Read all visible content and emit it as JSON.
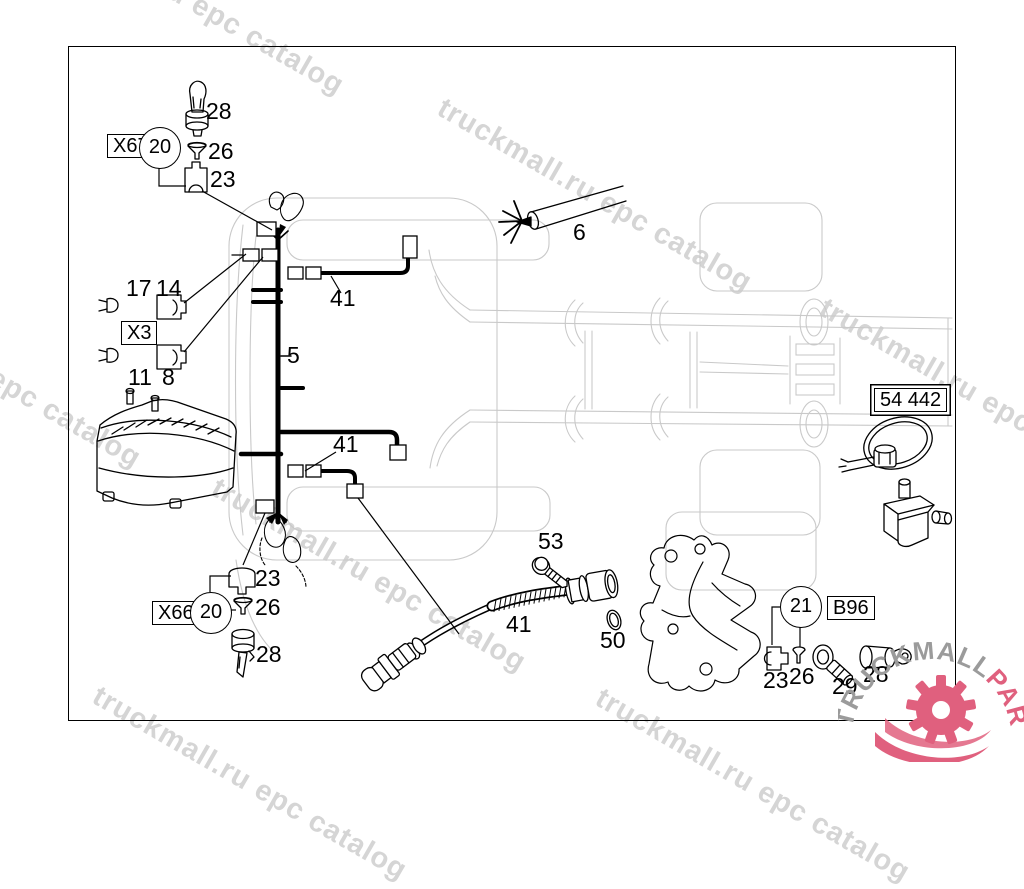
{
  "watermark": {
    "text": "truckmall.ru epc catalog",
    "color": "#d5d5d5"
  },
  "logo": {
    "name_gray": "TRUCKMALL",
    "name_pink": "PARTS",
    "gray": "#9b9b9b",
    "pink": "#e0607e"
  },
  "callouts": {
    "x67": {
      "box": "X67",
      "circle": "20",
      "bulb": "28",
      "nut": "26",
      "connector": "23"
    },
    "x3": {
      "box": "X3",
      "pin_top": "17",
      "connector_top": "14",
      "pin_bottom": "11",
      "connector_bottom": "8"
    },
    "harness": "5",
    "branch_upper": "41",
    "branch_lower": "41",
    "conduit": "6",
    "tie_box": "54 442",
    "bolt": "53",
    "oring": "50",
    "sensor_cable": "41",
    "b96": {
      "circle": "21",
      "box": "B96",
      "connector": "23",
      "pin": "26",
      "sensor_angle": "29",
      "sensor_straight": "28"
    },
    "x66": {
      "box": "X66",
      "circle": "20",
      "connector": "23",
      "nut": "26",
      "bulb": "28"
    }
  }
}
